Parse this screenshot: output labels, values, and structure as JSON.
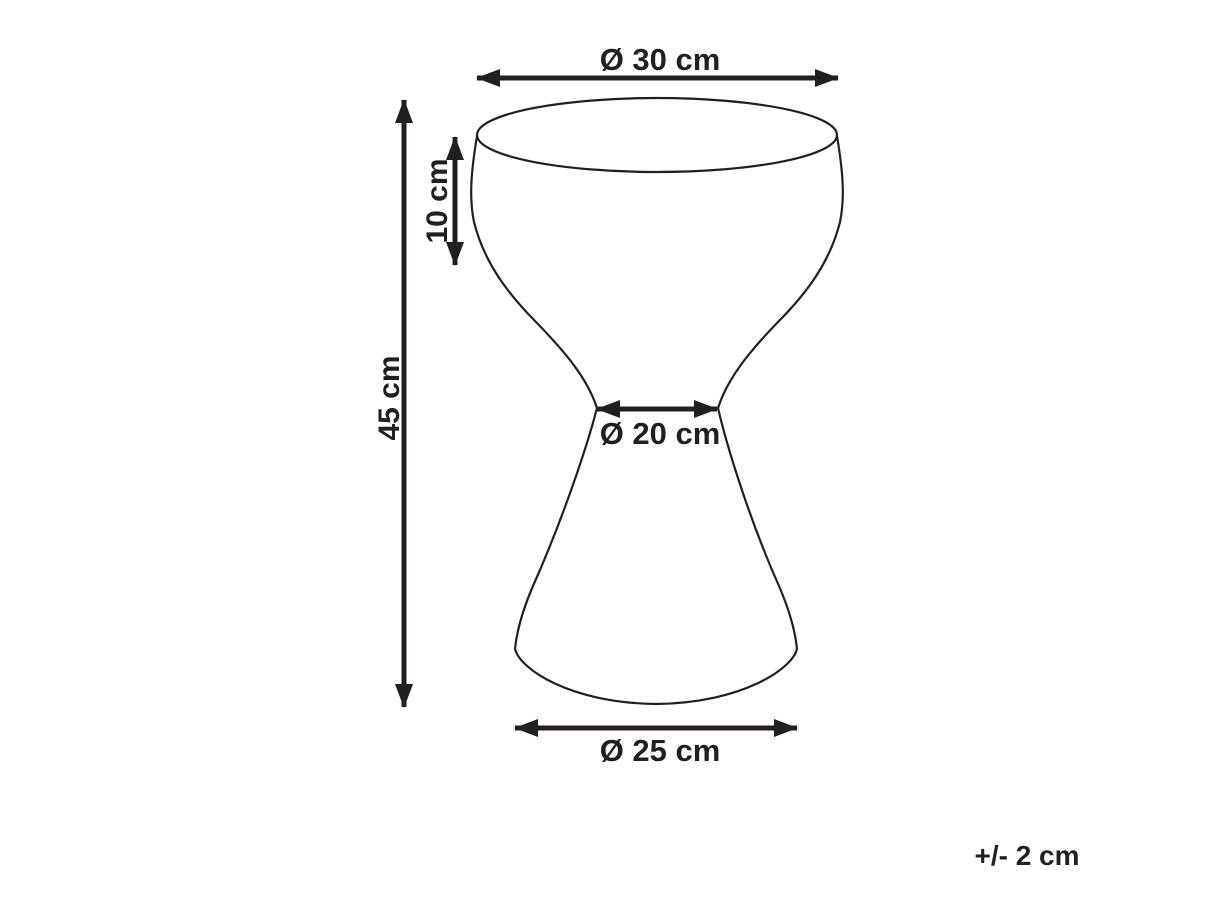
{
  "dimensions": {
    "top_diameter": "Ø 30 cm",
    "height": "45 cm",
    "bowl_depth": "10 cm",
    "waist_diameter": "Ø 20 cm",
    "base_diameter": "Ø 25 cm"
  },
  "tolerance_note": "+/- 2 cm",
  "colors": {
    "ink": "#231f20",
    "background": "#ffffff"
  }
}
